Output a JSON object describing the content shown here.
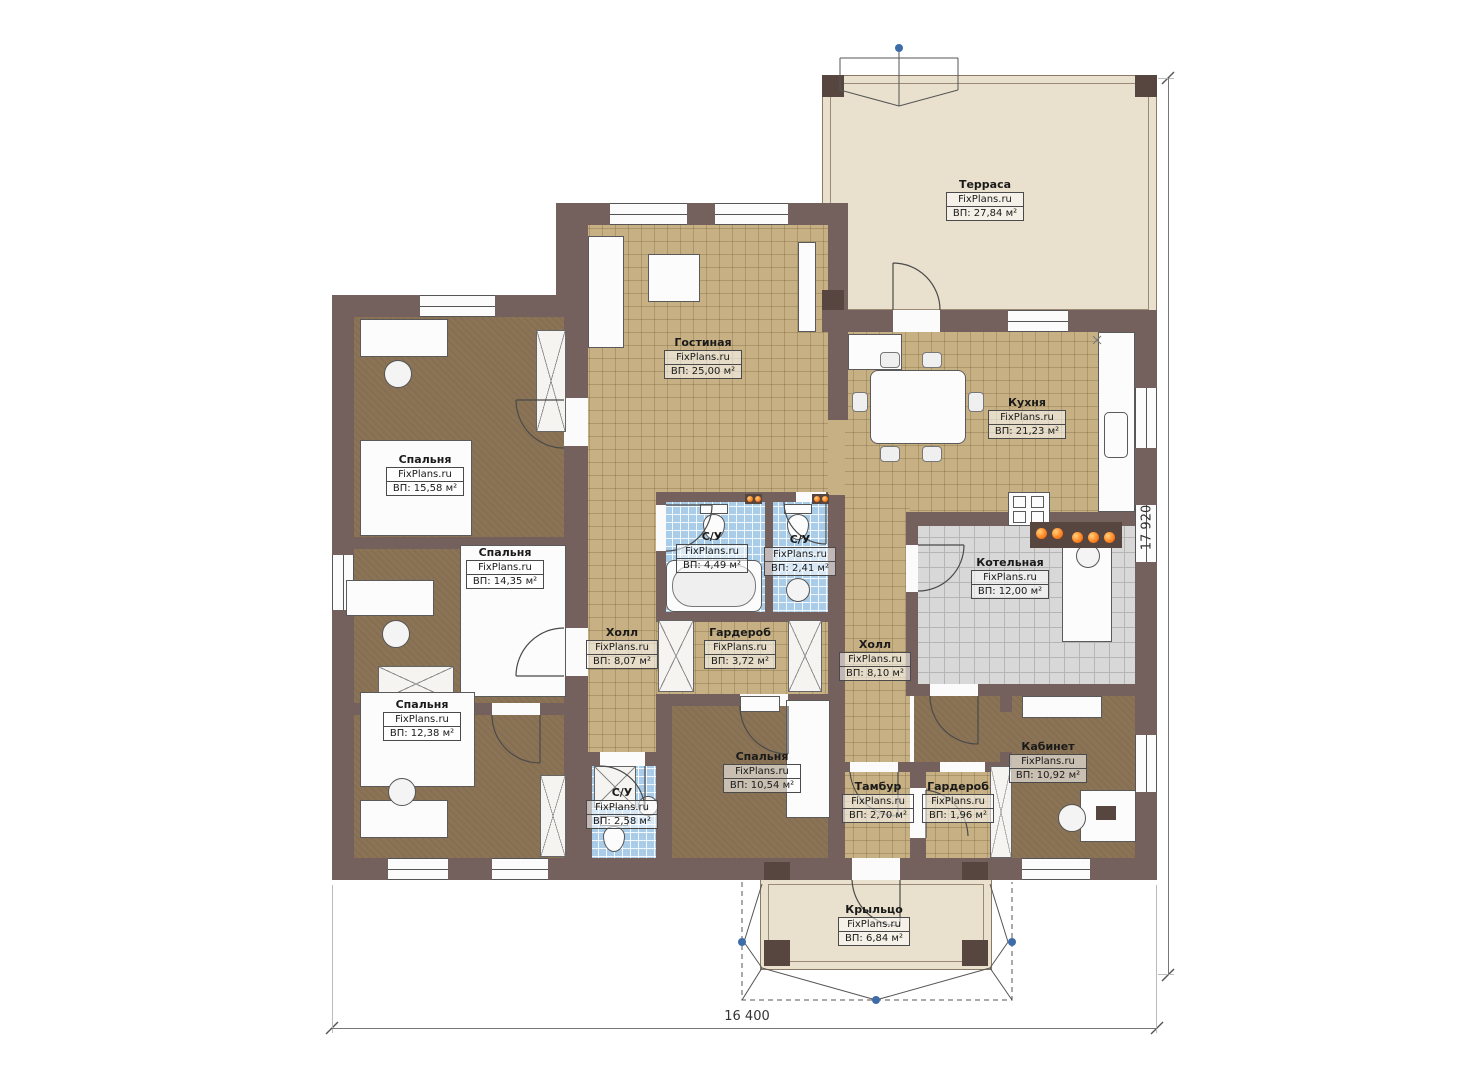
{
  "brand": "FixPlans.ru",
  "dimensions": {
    "bottom": "16 400",
    "right": "17 920"
  },
  "rooms": [
    {
      "key": "terrace",
      "name": "Терраса",
      "brand": "FixPlans.ru",
      "area": "ВП: 27,84 м²"
    },
    {
      "key": "living",
      "name": "Гостиная",
      "brand": "FixPlans.ru",
      "area": "ВП: 25,00 м²"
    },
    {
      "key": "kitchen",
      "name": "Кухня",
      "brand": "FixPlans.ru",
      "area": "ВП: 21,23 м²"
    },
    {
      "key": "bedroom-1",
      "name": "Спальня",
      "brand": "FixPlans.ru",
      "area": "ВП: 15,58 м²"
    },
    {
      "key": "bedroom-2",
      "name": "Спальня",
      "brand": "FixPlans.ru",
      "area": "ВП: 14,35 м²"
    },
    {
      "key": "bathroom-1",
      "name": "С/У",
      "brand": "FixPlans.ru",
      "area": "ВП: 4,49 м²"
    },
    {
      "key": "bathroom-2",
      "name": "С/У",
      "brand": "FixPlans.ru",
      "area": "ВП: 2,41 м²"
    },
    {
      "key": "hall-1",
      "name": "Холл",
      "brand": "FixPlans.ru",
      "area": "ВП: 8,07 м²"
    },
    {
      "key": "wardrobe-1",
      "name": "Гардероб",
      "brand": "FixPlans.ru",
      "area": "ВП: 3,72 м²"
    },
    {
      "key": "hall-2",
      "name": "Холл",
      "brand": "FixPlans.ru",
      "area": "ВП: 8,10 м²"
    },
    {
      "key": "boiler",
      "name": "Котельная",
      "brand": "FixPlans.ru",
      "area": "ВП: 12,00 м²"
    },
    {
      "key": "bedroom-3",
      "name": "Спальня",
      "brand": "FixPlans.ru",
      "area": "ВП: 12,38 м²"
    },
    {
      "key": "bedroom-4",
      "name": "Спальня",
      "brand": "FixPlans.ru",
      "area": "ВП: 10,54 м²"
    },
    {
      "key": "bathroom-3",
      "name": "С/У",
      "brand": "FixPlans.ru",
      "area": "ВП: 2,58 м²"
    },
    {
      "key": "tambour",
      "name": "Тамбур",
      "brand": "FixPlans.ru",
      "area": "ВП: 2,70 м²"
    },
    {
      "key": "wardrobe-2",
      "name": "Гардероб",
      "brand": "FixPlans.ru",
      "area": "ВП: 1,96 м²"
    },
    {
      "key": "office",
      "name": "Кабинет",
      "brand": "FixPlans.ru",
      "area": "ВП: 10,92 м²"
    },
    {
      "key": "porch",
      "name": "Крыльцо",
      "brand": "FixPlans.ru",
      "area": "ВП: 6,84 м²"
    }
  ],
  "colors": {
    "wall": "#74605d",
    "post": "#57463f",
    "floor_tan": "#c7b184",
    "floor_brown": "#8b7355",
    "tile_blue": "#a9cde8",
    "tile_gray": "#d8d8d8",
    "terrace": "#e9e0cd",
    "accent_orange": "#ff7f1f",
    "marker_blue": "#3d6ca8"
  }
}
